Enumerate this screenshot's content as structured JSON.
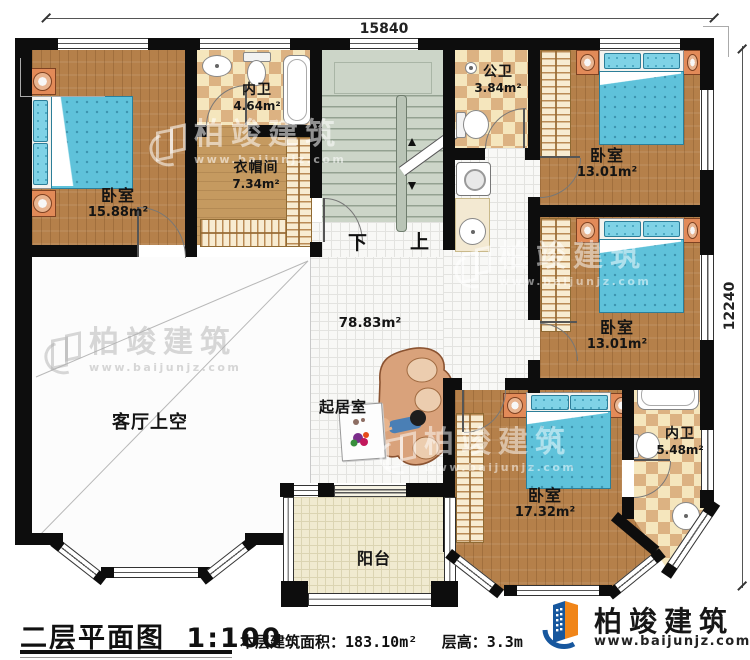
{
  "dimensions": {
    "top": "15840",
    "right": "12240"
  },
  "rooms": [
    {
      "name": "卧室",
      "area": "15.88m²"
    },
    {
      "name": "内卫",
      "area": "4.64m²"
    },
    {
      "name": "衣帽间",
      "area": "7.34m²"
    },
    {
      "name": "公卫",
      "area": "3.84m²"
    },
    {
      "name": "卧室",
      "area": "13.01m²"
    },
    {
      "name": "卧室",
      "area": "13.01m²"
    },
    {
      "name": "卧室",
      "area": "17.32m²"
    },
    {
      "name": "内卫",
      "area": "5.48m²"
    },
    {
      "name": "客厅上空"
    },
    {
      "name": "起居室"
    },
    {
      "name": "阳台"
    },
    {
      "area": "78.83m²"
    }
  ],
  "stairs": {
    "down": "下",
    "up": "上"
  },
  "footer": {
    "plan_title": "二层平面图",
    "scale": "1:100",
    "area_label": "本层建筑面积：",
    "area_value": "183.10m²",
    "height_label": "层高：",
    "height_value": "3.3m"
  },
  "branding": {
    "company": "柏竣建筑",
    "website": "www.baijunjz.com",
    "brand_blue": "#17579e",
    "brand_orange": "#f08519"
  }
}
